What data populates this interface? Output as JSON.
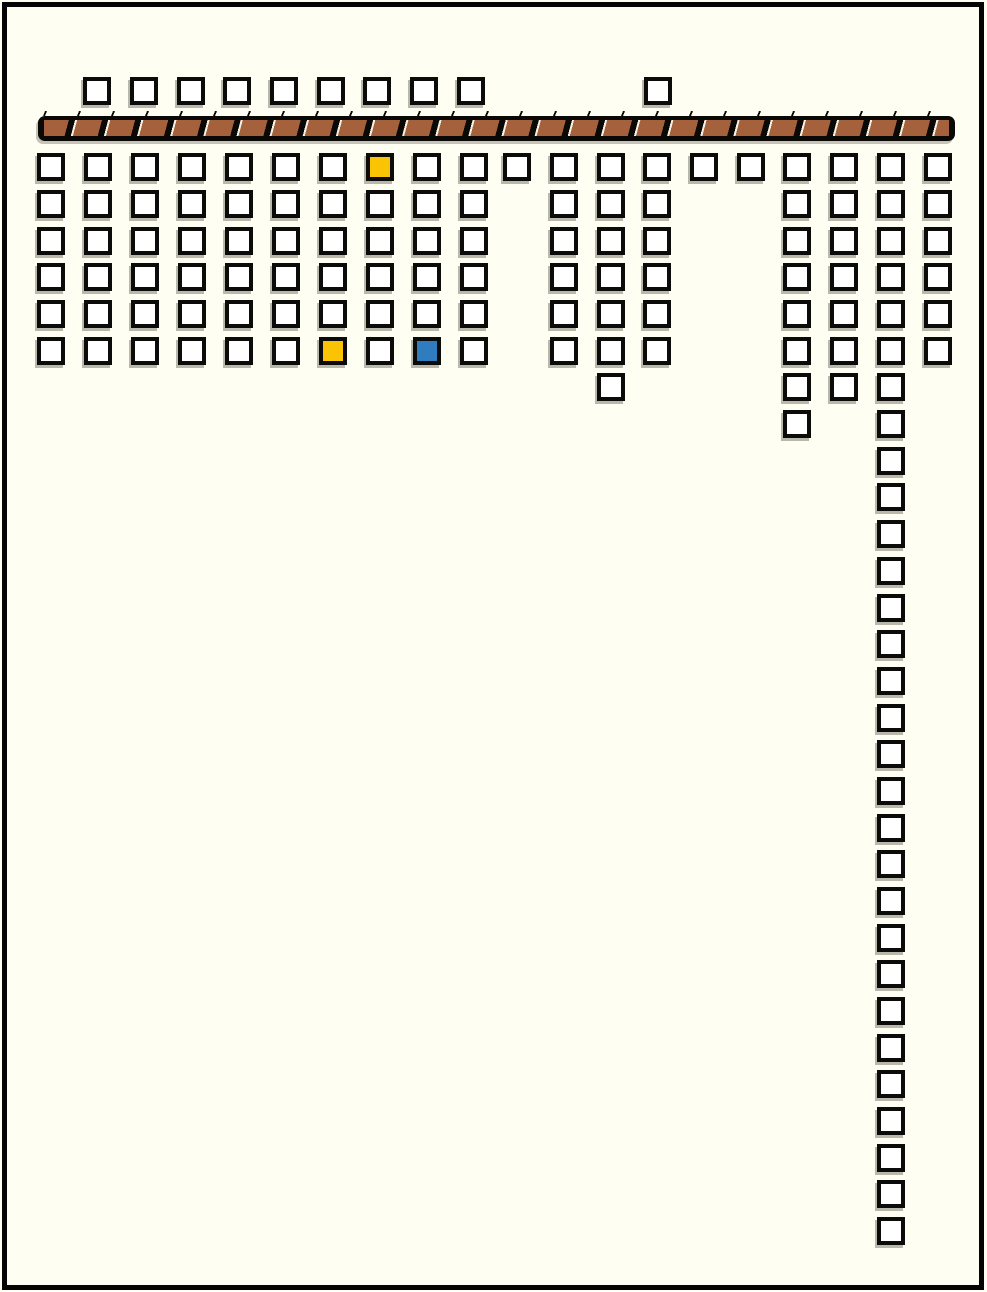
{
  "window": {
    "width": 987,
    "height": 1292,
    "background": "#FFFEF2",
    "frame_color": "#050505"
  },
  "board": {
    "square": {
      "size": 28,
      "border_width": 4,
      "border_color": "#0B0B09",
      "default_fill": "#FFFFFF",
      "shadow_color": "#807E70"
    },
    "colors": {
      "w": "#FFFFFF",
      "y": "#FAC303",
      "b": "#2F7CBE"
    },
    "beam": {
      "x": 38,
      "y": 116,
      "width": 917,
      "height": 25,
      "radius": 7,
      "edge_color": "#0A0906",
      "plank_color": "#A5613C",
      "highlight_color": "#F5F2E4",
      "segment_pitch": 32,
      "ticks": {
        "x": 44,
        "y": 111,
        "width": 905,
        "height": 5,
        "pitch": 34,
        "mark_width": 2,
        "color": "#0A0906"
      }
    },
    "squares": [
      [
        83,
        77,
        "w"
      ],
      [
        130,
        77,
        "w"
      ],
      [
        177,
        77,
        "w"
      ],
      [
        223,
        77,
        "w"
      ],
      [
        270,
        77,
        "w"
      ],
      [
        317,
        77,
        "w"
      ],
      [
        363,
        77,
        "w"
      ],
      [
        410,
        77,
        "w"
      ],
      [
        457,
        77,
        "w"
      ],
      [
        644,
        77,
        "w"
      ],
      [
        37,
        153,
        "w"
      ],
      [
        84,
        153,
        "w"
      ],
      [
        131,
        153,
        "w"
      ],
      [
        178,
        153,
        "w"
      ],
      [
        225,
        153,
        "w"
      ],
      [
        272,
        153,
        "w"
      ],
      [
        319,
        153,
        "w"
      ],
      [
        366,
        153,
        "y"
      ],
      [
        413,
        153,
        "w"
      ],
      [
        460,
        153,
        "w"
      ],
      [
        503,
        153,
        "w"
      ],
      [
        550,
        153,
        "w"
      ],
      [
        597,
        153,
        "w"
      ],
      [
        643,
        153,
        "w"
      ],
      [
        690,
        153,
        "w"
      ],
      [
        737,
        153,
        "w"
      ],
      [
        783,
        153,
        "w"
      ],
      [
        830,
        153,
        "w"
      ],
      [
        877,
        153,
        "w"
      ],
      [
        924,
        153,
        "w"
      ],
      [
        37,
        190,
        "w"
      ],
      [
        84,
        190,
        "w"
      ],
      [
        131,
        190,
        "w"
      ],
      [
        178,
        190,
        "w"
      ],
      [
        225,
        190,
        "w"
      ],
      [
        272,
        190,
        "w"
      ],
      [
        319,
        190,
        "w"
      ],
      [
        366,
        190,
        "w"
      ],
      [
        413,
        190,
        "w"
      ],
      [
        460,
        190,
        "w"
      ],
      [
        550,
        190,
        "w"
      ],
      [
        597,
        190,
        "w"
      ],
      [
        643,
        190,
        "w"
      ],
      [
        783,
        190,
        "w"
      ],
      [
        830,
        190,
        "w"
      ],
      [
        877,
        190,
        "w"
      ],
      [
        924,
        190,
        "w"
      ],
      [
        37,
        227,
        "w"
      ],
      [
        84,
        227,
        "w"
      ],
      [
        131,
        227,
        "w"
      ],
      [
        178,
        227,
        "w"
      ],
      [
        225,
        227,
        "w"
      ],
      [
        272,
        227,
        "w"
      ],
      [
        319,
        227,
        "w"
      ],
      [
        366,
        227,
        "w"
      ],
      [
        413,
        227,
        "w"
      ],
      [
        460,
        227,
        "w"
      ],
      [
        550,
        227,
        "w"
      ],
      [
        597,
        227,
        "w"
      ],
      [
        643,
        227,
        "w"
      ],
      [
        783,
        227,
        "w"
      ],
      [
        830,
        227,
        "w"
      ],
      [
        877,
        227,
        "w"
      ],
      [
        924,
        227,
        "w"
      ],
      [
        37,
        263,
        "w"
      ],
      [
        84,
        263,
        "w"
      ],
      [
        131,
        263,
        "w"
      ],
      [
        178,
        263,
        "w"
      ],
      [
        225,
        263,
        "w"
      ],
      [
        272,
        263,
        "w"
      ],
      [
        319,
        263,
        "w"
      ],
      [
        366,
        263,
        "w"
      ],
      [
        413,
        263,
        "w"
      ],
      [
        460,
        263,
        "w"
      ],
      [
        550,
        263,
        "w"
      ],
      [
        597,
        263,
        "w"
      ],
      [
        643,
        263,
        "w"
      ],
      [
        783,
        263,
        "w"
      ],
      [
        830,
        263,
        "w"
      ],
      [
        877,
        263,
        "w"
      ],
      [
        924,
        263,
        "w"
      ],
      [
        37,
        300,
        "w"
      ],
      [
        84,
        300,
        "w"
      ],
      [
        131,
        300,
        "w"
      ],
      [
        178,
        300,
        "w"
      ],
      [
        225,
        300,
        "w"
      ],
      [
        272,
        300,
        "w"
      ],
      [
        319,
        300,
        "w"
      ],
      [
        366,
        300,
        "w"
      ],
      [
        413,
        300,
        "w"
      ],
      [
        460,
        300,
        "w"
      ],
      [
        550,
        300,
        "w"
      ],
      [
        597,
        300,
        "w"
      ],
      [
        643,
        300,
        "w"
      ],
      [
        783,
        300,
        "w"
      ],
      [
        830,
        300,
        "w"
      ],
      [
        877,
        300,
        "w"
      ],
      [
        924,
        300,
        "w"
      ],
      [
        37,
        337,
        "w"
      ],
      [
        84,
        337,
        "w"
      ],
      [
        131,
        337,
        "w"
      ],
      [
        178,
        337,
        "w"
      ],
      [
        225,
        337,
        "w"
      ],
      [
        272,
        337,
        "w"
      ],
      [
        319,
        337,
        "y"
      ],
      [
        366,
        337,
        "w"
      ],
      [
        413,
        337,
        "b"
      ],
      [
        460,
        337,
        "w"
      ],
      [
        550,
        337,
        "w"
      ],
      [
        597,
        337,
        "w"
      ],
      [
        643,
        337,
        "w"
      ],
      [
        783,
        337,
        "w"
      ],
      [
        830,
        337,
        "w"
      ],
      [
        877,
        337,
        "w"
      ],
      [
        924,
        337,
        "w"
      ],
      [
        597,
        373,
        "w"
      ],
      [
        783,
        373,
        "w"
      ],
      [
        830,
        373,
        "w"
      ],
      [
        877,
        373,
        "w"
      ],
      [
        783,
        410,
        "w"
      ],
      [
        877,
        410,
        "w"
      ],
      [
        877,
        447,
        "w"
      ],
      [
        877,
        483,
        "w"
      ],
      [
        877,
        520,
        "w"
      ],
      [
        877,
        557,
        "w"
      ],
      [
        877,
        594,
        "w"
      ],
      [
        877,
        630,
        "w"
      ],
      [
        877,
        667,
        "w"
      ],
      [
        877,
        704,
        "w"
      ],
      [
        877,
        740,
        "w"
      ],
      [
        877,
        777,
        "w"
      ],
      [
        877,
        814,
        "w"
      ],
      [
        877,
        850,
        "w"
      ],
      [
        877,
        887,
        "w"
      ],
      [
        877,
        924,
        "w"
      ],
      [
        877,
        960,
        "w"
      ],
      [
        877,
        997,
        "w"
      ],
      [
        877,
        1034,
        "w"
      ],
      [
        877,
        1070,
        "w"
      ],
      [
        877,
        1107,
        "w"
      ],
      [
        877,
        1144,
        "w"
      ],
      [
        877,
        1180,
        "w"
      ],
      [
        877,
        1217,
        "w"
      ]
    ]
  }
}
